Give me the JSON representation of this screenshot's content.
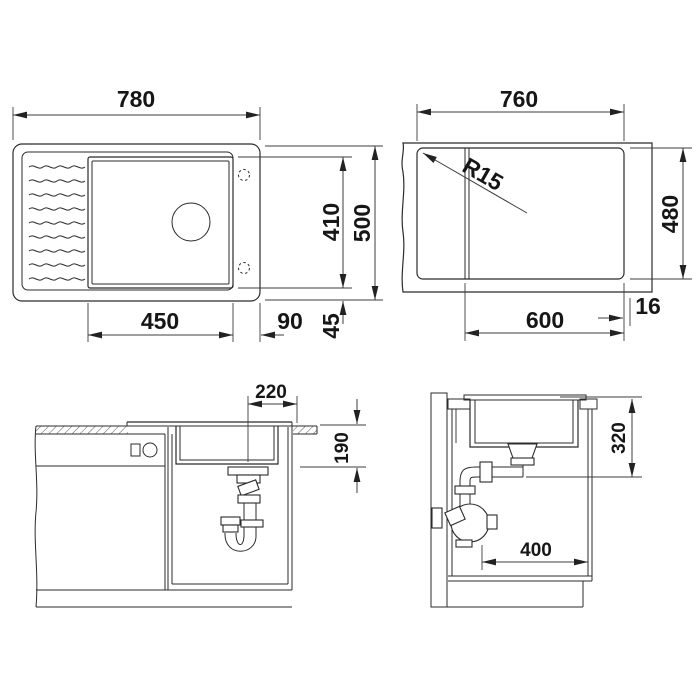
{
  "colors": {
    "background": "#ffffff",
    "line": "#2b2b2b",
    "dimension_line": "#3c3c3c",
    "text": "#161616"
  },
  "views": {
    "top": {
      "overall_width": "780",
      "overall_depth": "500",
      "bowl_length": "450",
      "bowl_width": "410",
      "tap_deck": "90",
      "bowl_edge_offset": "45"
    },
    "cutout": {
      "width": "760",
      "depth": "480",
      "from_fold": "600",
      "edge": "16",
      "corner_radius": "R15"
    },
    "front": {
      "drain_offset": "220",
      "bowl_depth": "190"
    },
    "side": {
      "outlet_drop": "320",
      "base_clearance": "400"
    }
  }
}
